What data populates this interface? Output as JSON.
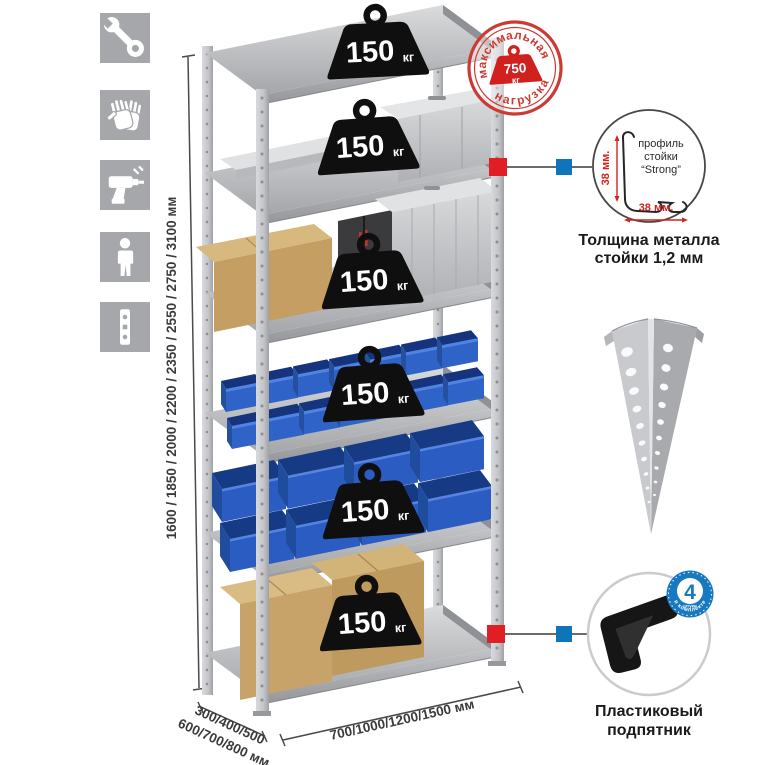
{
  "sidebar": {
    "icons": [
      {
        "name": "wrench"
      },
      {
        "name": "gloves"
      },
      {
        "name": "drill"
      },
      {
        "name": "person"
      },
      {
        "name": "rack-post"
      }
    ]
  },
  "shelf_badge": {
    "value": "150",
    "unit": "кг"
  },
  "stamp": {
    "arc_top": "максимальная",
    "arc_bottom": "нагрузка",
    "weight_value": "750",
    "weight_unit": "кг"
  },
  "dimensions": {
    "height_label": "1600 / 1850 / 2000 / 2200 / 2350 / 2550 / 2750 / 3100 мм",
    "depth_label_line1": "300/400/500",
    "depth_label_line2": "600/700/800 мм",
    "width_label": "700/1000/1200/1500 мм"
  },
  "profile_detail": {
    "dim_vertical": "38 мм.",
    "dim_horizontal": "38 мм.",
    "label_line1": "профиль",
    "label_line2": "стойки",
    "label_line3": "“Strong”",
    "caption_line1": "Толщина металла",
    "caption_line2": "стойки 1,2 мм"
  },
  "foot_detail": {
    "badge_number": "4",
    "badge_small_text": "штуки",
    "badge_arc_text": "в комплекте",
    "caption_line1": "Пластиковый",
    "caption_line2": "подпятник"
  },
  "colors": {
    "stamp_red": "#cd3a34",
    "marker_red": "#e01e24",
    "marker_blue": "#0f75bb",
    "badge_black": "#0f0f0f",
    "bin_blue": "#2b5cc2",
    "icon_tile_gray": "#a6a7ab",
    "metal_gray": "#c6c8cb",
    "cardboard_tan": "#c7a269",
    "dim_text": "#3b3b3d",
    "red_dim_text": "#d0241e"
  }
}
